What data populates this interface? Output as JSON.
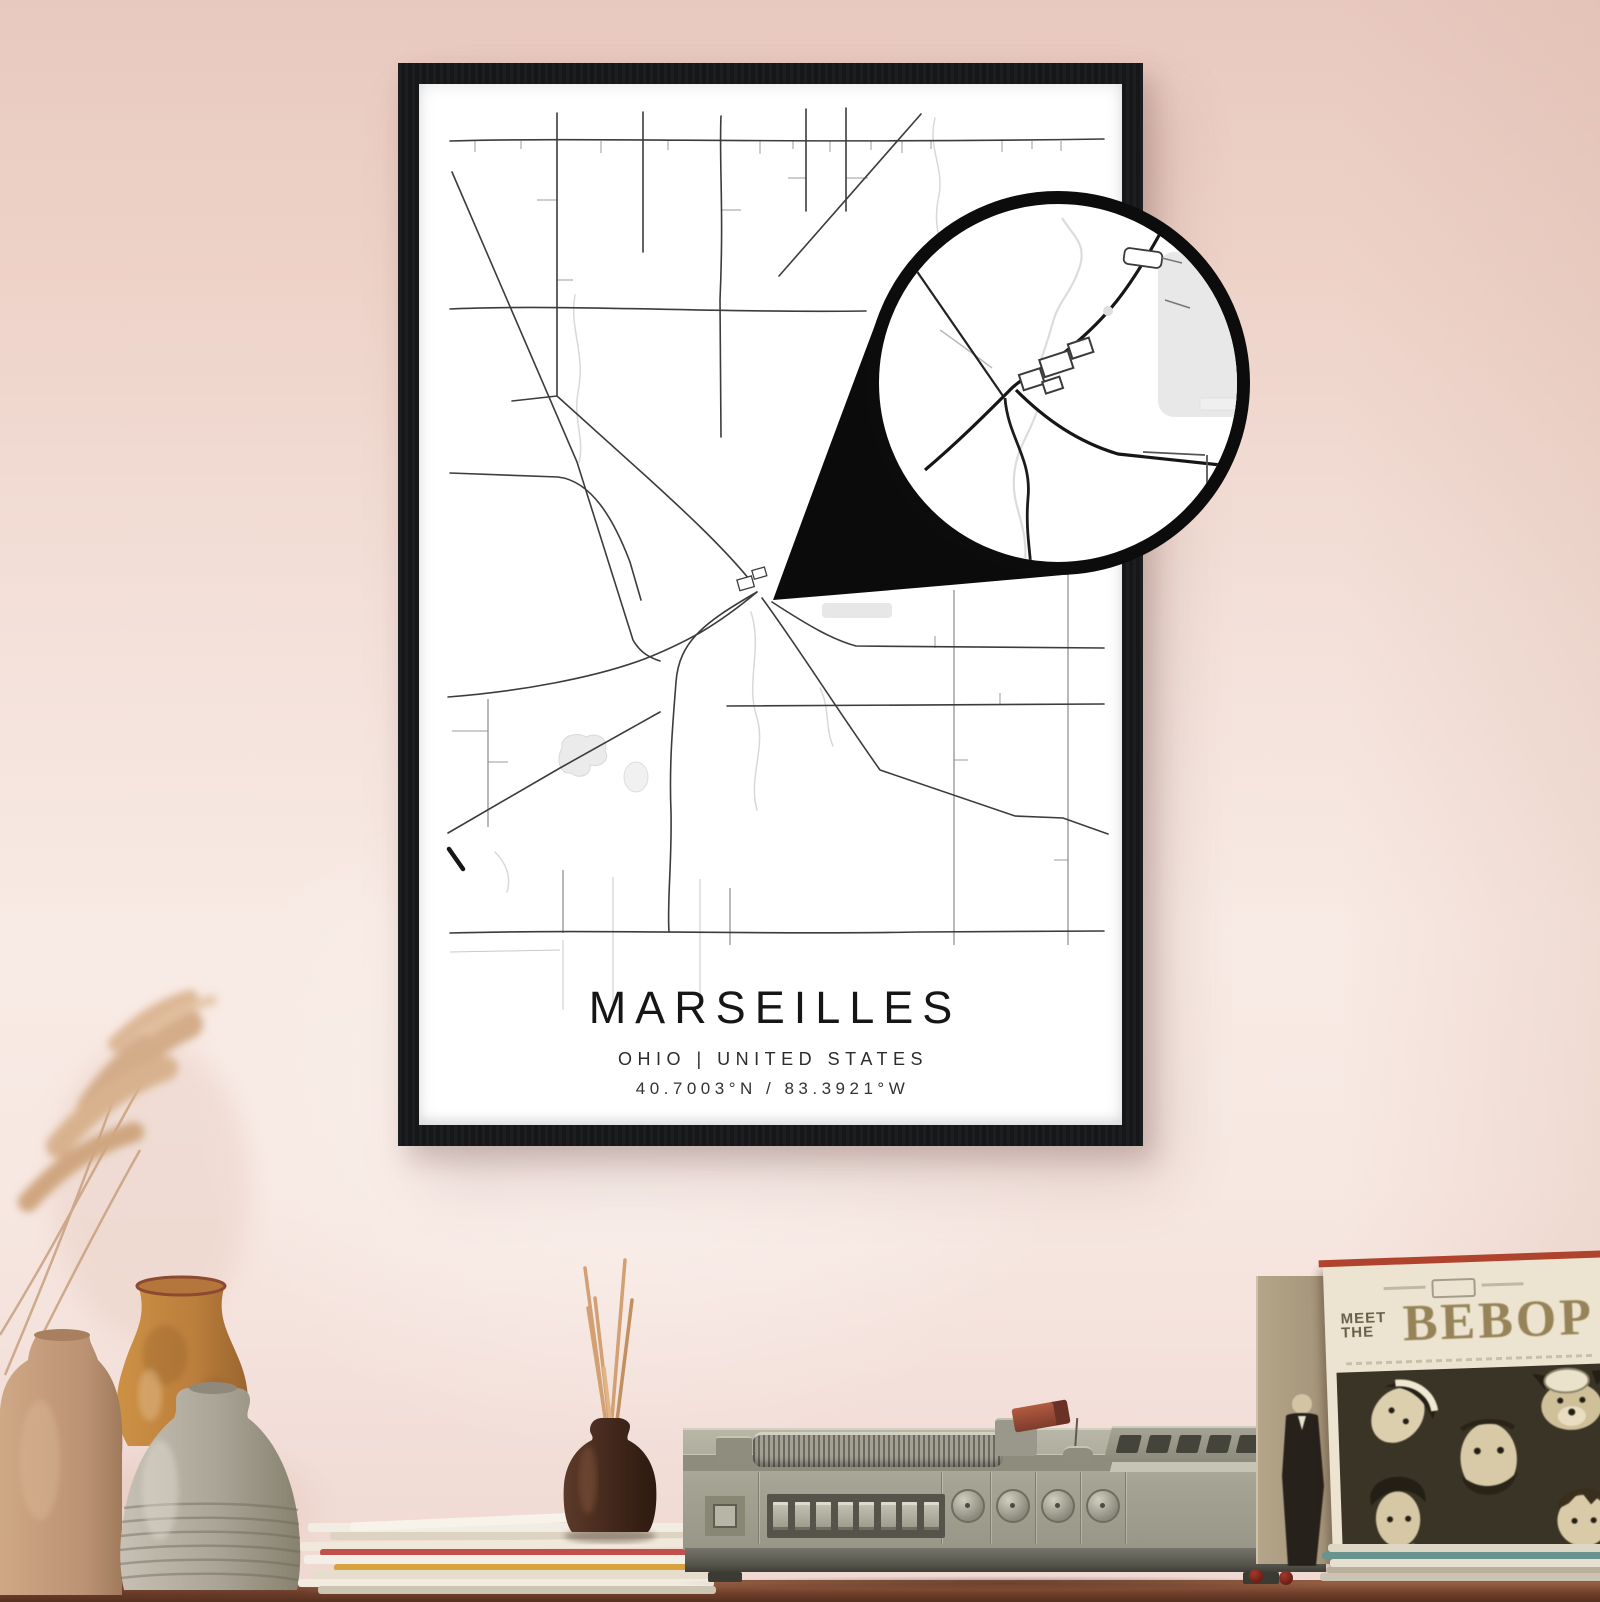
{
  "poster": {
    "title": "MARSEILLES",
    "subtitle": "OHIO | UNITED STATES",
    "coordinates": "40.7003°N / 83.3921°W"
  },
  "album": {
    "meet": "MEET",
    "the": "THE",
    "title": "BEBOP"
  },
  "colors": {
    "wall_top": "#e8c9bf",
    "wall_light": "#f8eae4",
    "frame": "#17181a",
    "poster_background": "#ffffff",
    "map_road": "#3c3c3c",
    "map_water": "#d8d8d8",
    "callout_black": "#0b0b0b",
    "table_wood": "#7c4a33",
    "record_player_body": "#a8a697",
    "album_cover_cream": "#ece4d0",
    "album_title_ink": "#968357",
    "album_top_edge_red": "#b0432e"
  }
}
